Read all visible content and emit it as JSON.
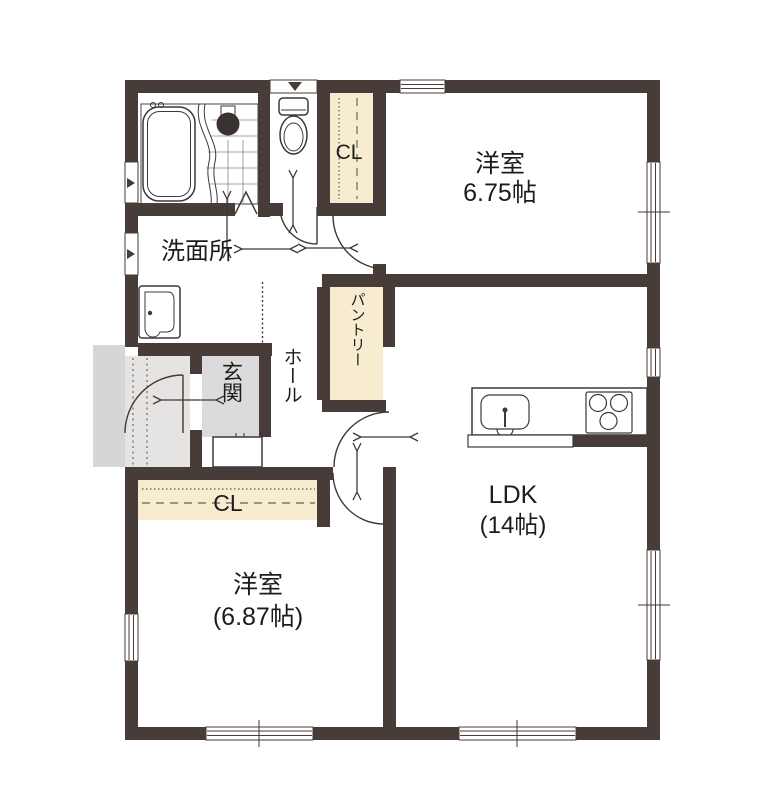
{
  "plan": {
    "type": "floorplan",
    "rooms": {
      "western_room_top": {
        "name": "洋室",
        "size": "6.75帖"
      },
      "western_room_bottom": {
        "name": "洋室",
        "size": "(6.87帖)"
      },
      "ldk": {
        "name": "LDK",
        "size": "(14帖)"
      },
      "washroom": {
        "label": "洗面所"
      },
      "entrance": {
        "label": "玄関"
      },
      "hall": {
        "label": "ホール"
      },
      "pantry": {
        "label": "パントリー"
      },
      "closet_top": {
        "label": "CL"
      },
      "closet_bottom": {
        "label": "CL"
      }
    },
    "colors": {
      "wall": "#473C38",
      "closet": "#F8ECD0",
      "entrance_floor": "#DBDBDB",
      "alcove": "#E6E4E2",
      "porch": "#D6D6D6",
      "line": "#3F3835"
    }
  }
}
